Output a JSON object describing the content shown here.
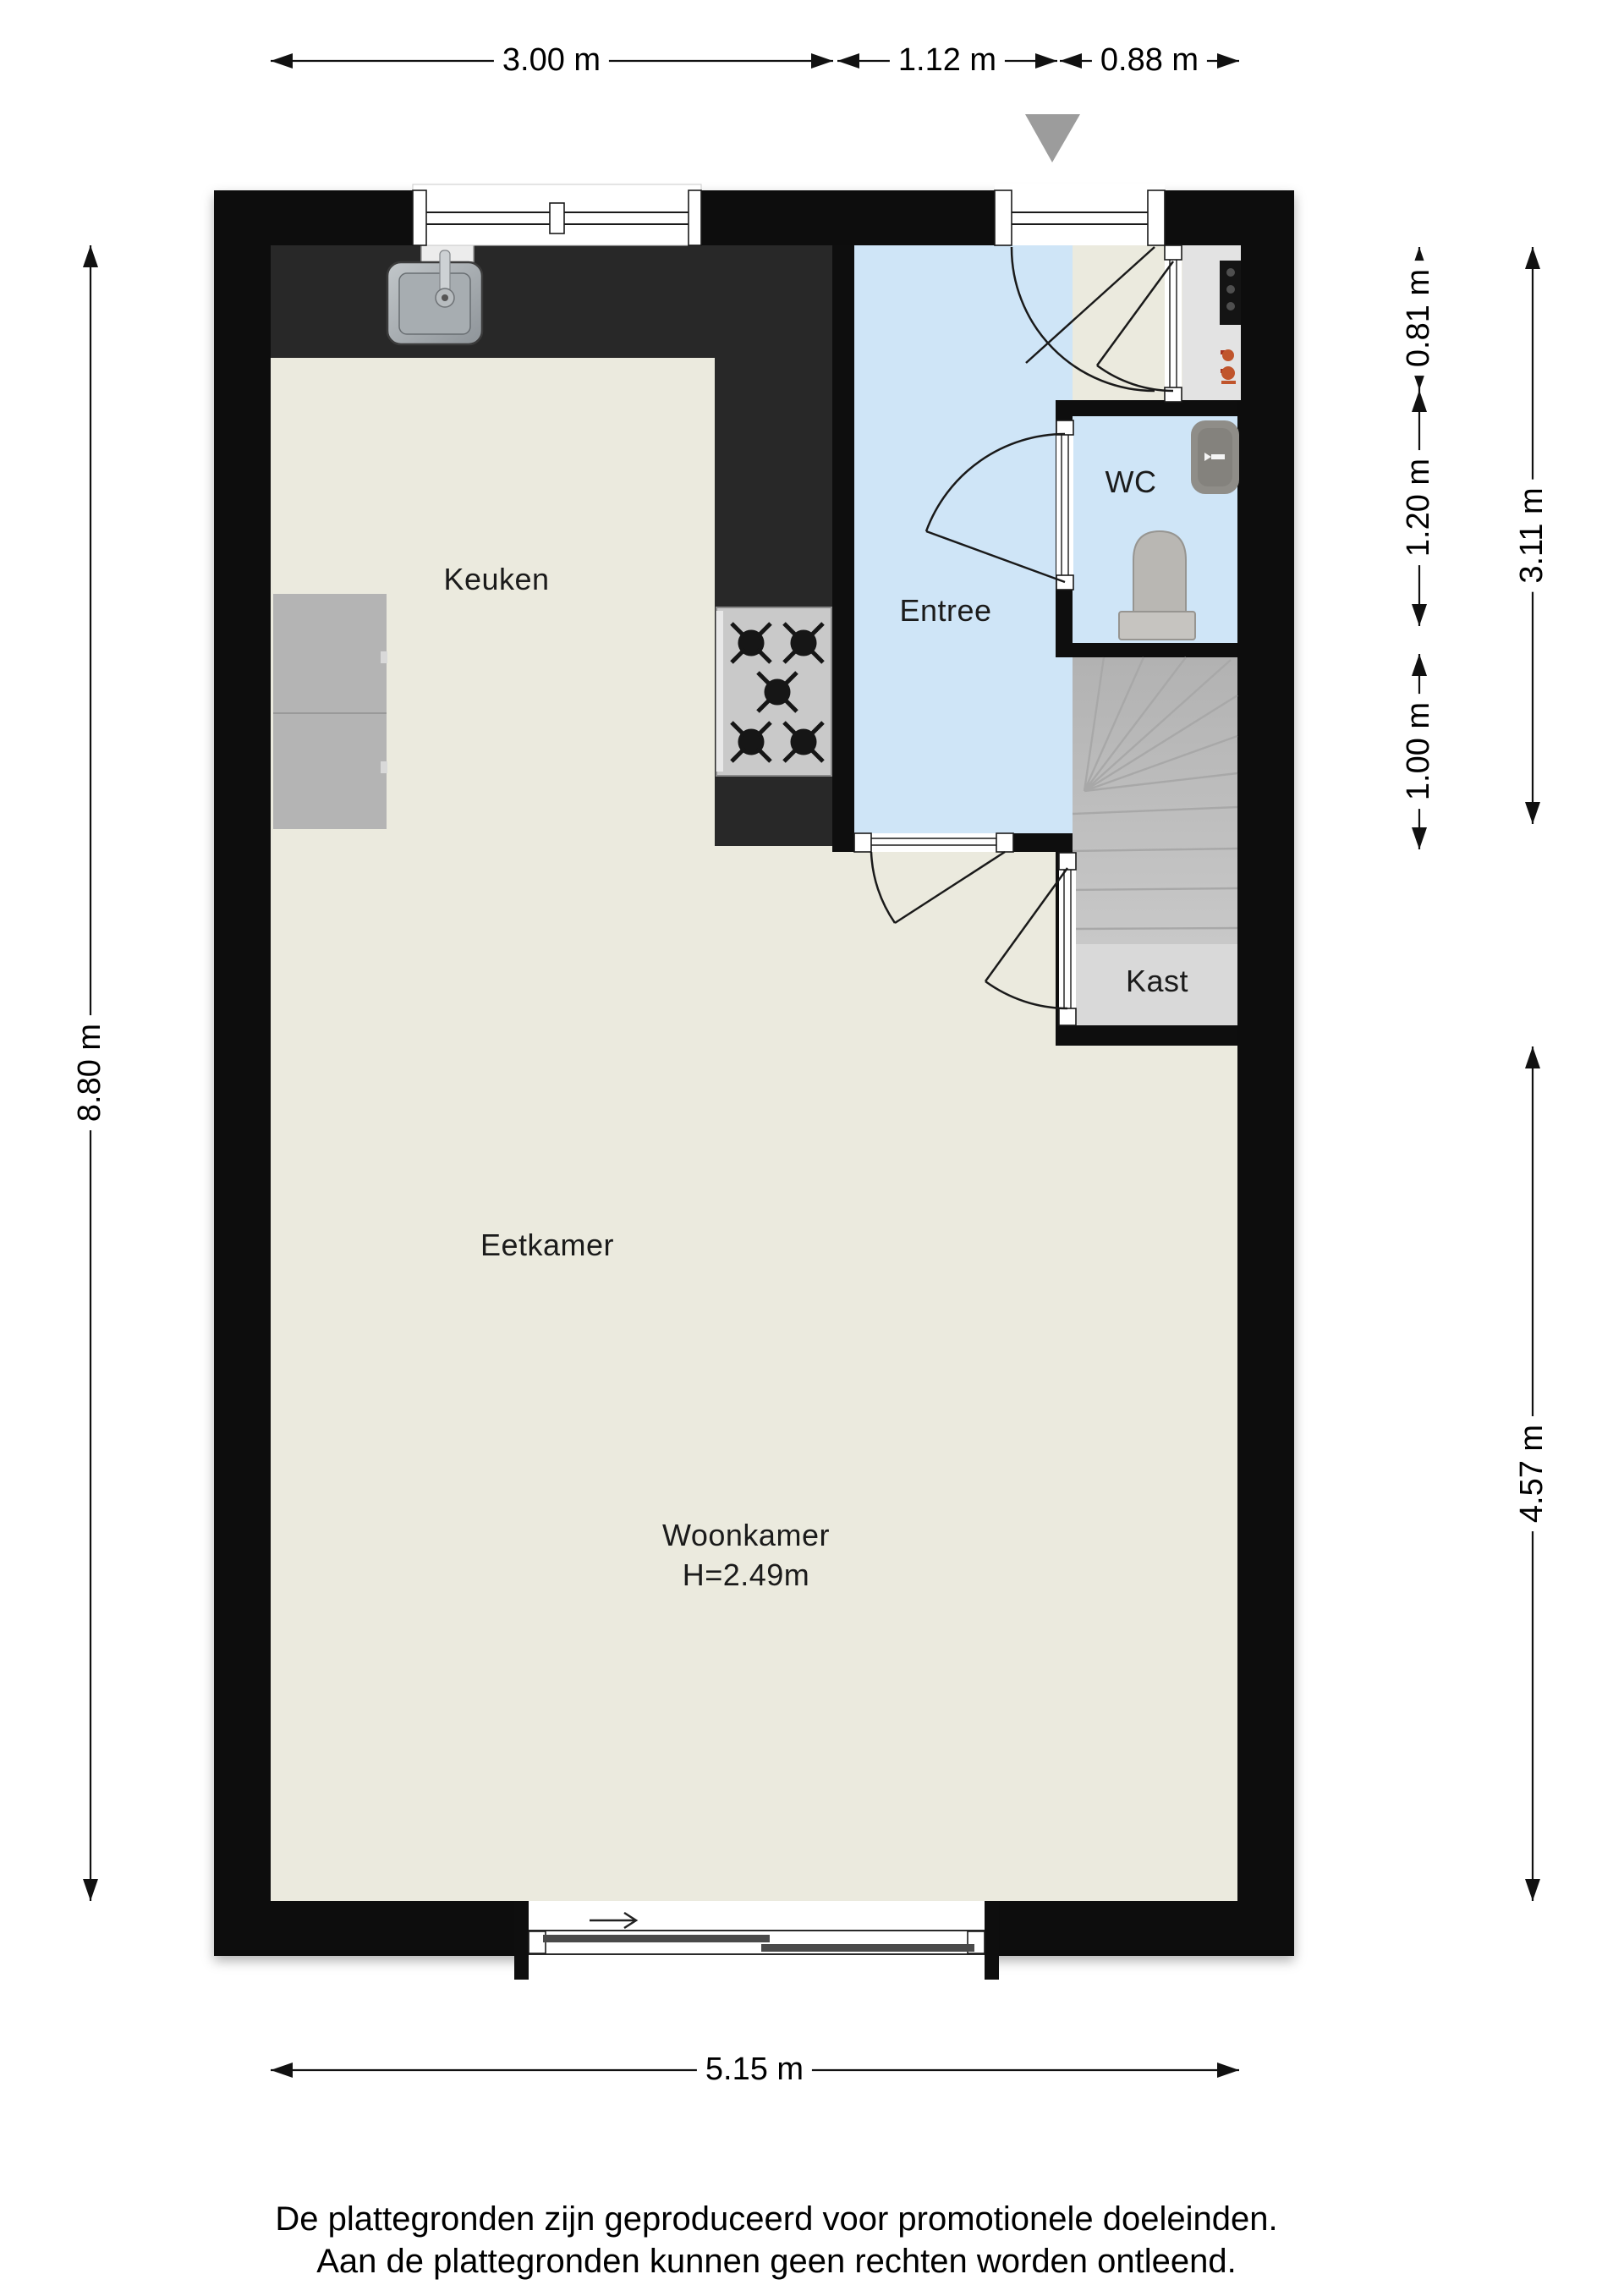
{
  "plan": {
    "rooms": [
      {
        "id": "keuken",
        "label": "Keuken"
      },
      {
        "id": "entree",
        "label": "Entree"
      },
      {
        "id": "wc",
        "label": "WC"
      },
      {
        "id": "kast",
        "label": "Kast"
      },
      {
        "id": "eetkamer",
        "label": "Eetkamer"
      },
      {
        "id": "woonkamer",
        "label": "Woonkamer",
        "height_note": "H=2.49m"
      }
    ],
    "dimensions": {
      "top": [
        {
          "label": "3.00 m"
        },
        {
          "label": "1.12 m"
        },
        {
          "label": "0.88 m"
        }
      ],
      "left": [
        {
          "label": "8.80 m"
        }
      ],
      "right_inner": [
        {
          "label": "0.81 m"
        },
        {
          "label": "1.20 m"
        },
        {
          "label": "1.00 m"
        }
      ],
      "right_outer": [
        {
          "label": "3.11 m"
        },
        {
          "label": "4.57 m"
        }
      ],
      "bottom": [
        {
          "label": "5.15 m"
        }
      ]
    }
  },
  "footer": {
    "line1": "De plattegronden zijn geproduceerd voor promotionele doeleinden.",
    "line2": "Aan de plattegronden kunnen geen rechten worden ontleend."
  },
  "colors": {
    "wall": "#0e0e0e",
    "floor": "#ebeade",
    "entree_floor": "#cfe5f7",
    "counter": "#282828",
    "stairs": "#bdbdbd",
    "kast": "#d9d9d9",
    "appliance": "#b4b4b4",
    "stove": "#c9c9c9",
    "closet": "#e3e3e3",
    "entrance_marker": "#9c9c9c",
    "boiler_accent": "#c0552c"
  }
}
